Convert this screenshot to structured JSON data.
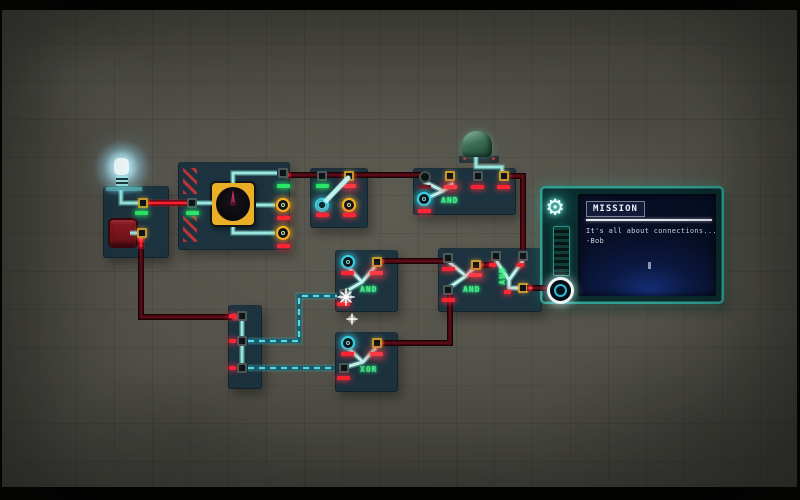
{
  "labels": {
    "gate_and_top": "AND",
    "gate_and_mid": "AND",
    "gate_and_right": "AND",
    "gate_and_vertical": "AND",
    "gate_xor": "XOR"
  },
  "mission": {
    "title": "MISSION",
    "line1": "It's all about connections...",
    "line2": "-Bob"
  },
  "icons": {
    "gear_glyph": "⚙"
  },
  "colors": {
    "background": "#55544b",
    "module_panel": "#1d3440",
    "wire_power": "#5a0d17",
    "wire_power_active": "#ff2030",
    "wire_signal_cyan": "#54dcee",
    "wire_internal_cyan": "#9ae8de",
    "gate_label_green": "#43f287",
    "indicator_red": "#ff2433",
    "indicator_green": "#2ae767",
    "port_orange": "#ffb01e",
    "port_cyan": "#38d2e4",
    "dial_yellow": "#e9af25",
    "mission_frame_teal": "#2fa093",
    "screen_navy": "#0c1a44"
  }
}
